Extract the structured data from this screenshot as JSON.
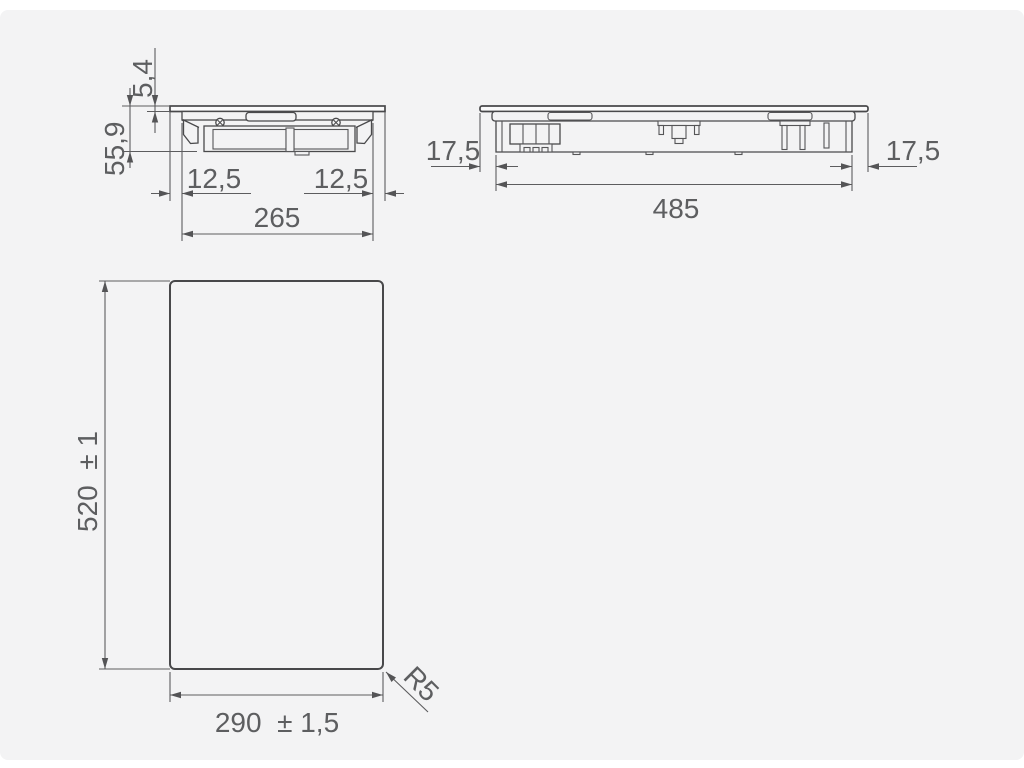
{
  "page": {
    "background_color": "#ffffff",
    "panel_color": "#f3f3f4",
    "line_color": "#4a4a4c",
    "text_color": "#5d5e60"
  },
  "drawing": {
    "kind": "installation dimension drawing",
    "width_section": {
      "description": "side section across the width of the hob",
      "glass_thickness": "5,4",
      "overall_height": "55,9",
      "left_overhang": "12,5",
      "right_overhang": "12,5",
      "body_width": "265"
    },
    "length_section": {
      "description": "side section along the length of the hob",
      "left_overhang": "17,5",
      "body_length": "485",
      "right_overhang": "17,5"
    },
    "cutout": {
      "description": "worktop cutout plan view",
      "depth": "520  ± 1",
      "width": "290  ± 1,5",
      "corner_radius": "R5"
    }
  }
}
